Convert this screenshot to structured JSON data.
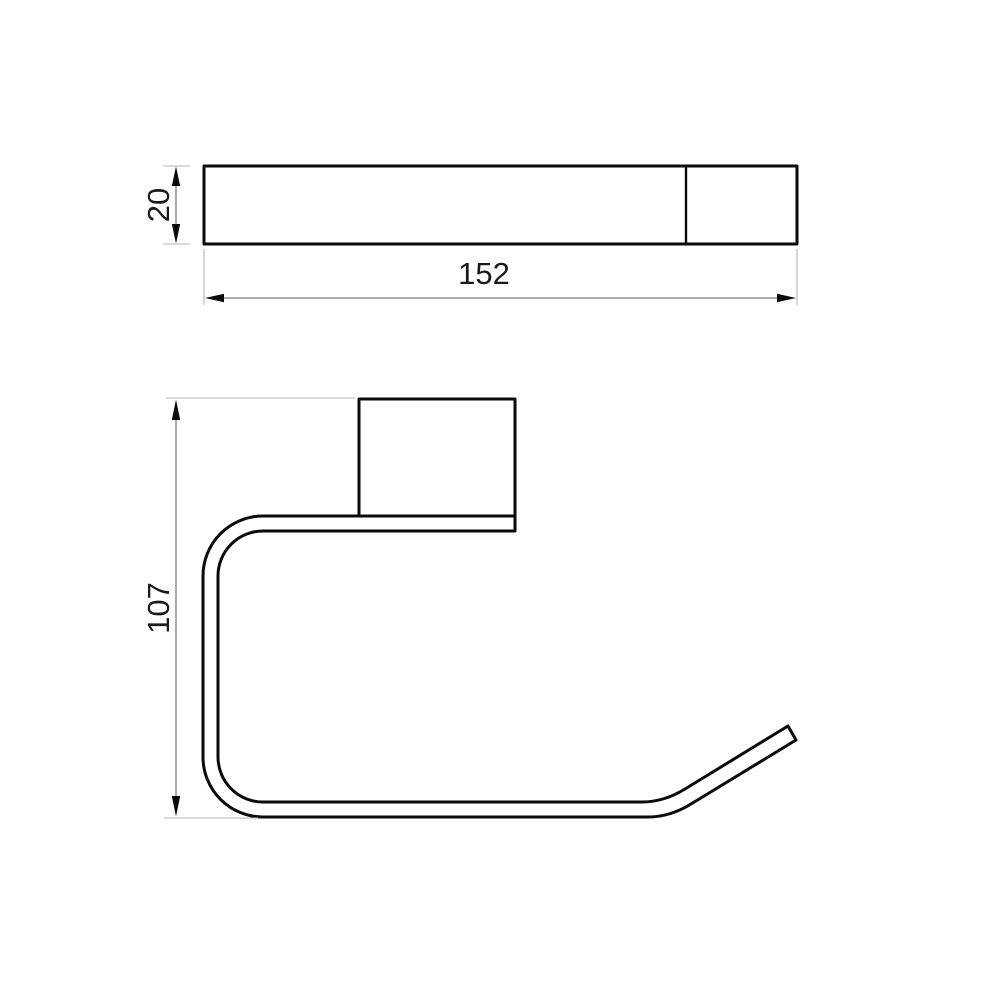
{
  "drawing": {
    "top_view": {
      "length_label": "152",
      "thickness_label": "20"
    },
    "side_view": {
      "height_label": "107"
    },
    "colors": {
      "outline": "#0a0a0a",
      "dimension_line": "#7a7a7a",
      "extension_line": "#b4b4b4",
      "text": "#1a1a1a",
      "background": "#ffffff"
    }
  }
}
